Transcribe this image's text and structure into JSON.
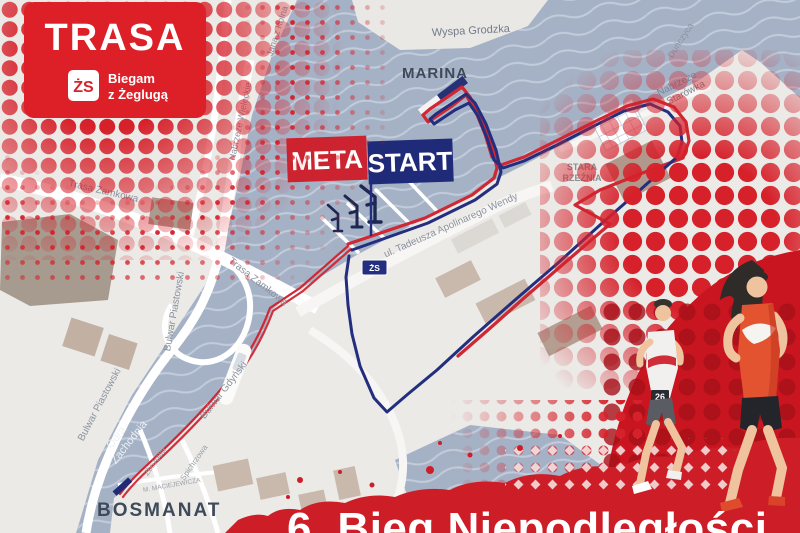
{
  "poster": {
    "title": "TRASA",
    "logo": {
      "initials": "ŻS",
      "line1": "Biegam",
      "line2": "z Żeglugą"
    },
    "event_title": "6. Bieg Niepodległości"
  },
  "route": {
    "finish_label": "META",
    "start_label": "START",
    "badge_label": "ŻS"
  },
  "map": {
    "labels": {
      "wyspa_grodzka": "Wyspa Grodzka",
      "marina": "MARINA",
      "dunczyca": "Duńczyca",
      "starowka_1": "Nabrzeże",
      "starowka_2": "Starówka",
      "stara_rzeznia_1": "STARA",
      "stara_rzeznia_2": "RZEŹNIA",
      "wendy": "ul. Tadeusza Apolinarego Wendy",
      "jana_z_kolna": "Jana z Kolna",
      "nabrzeze_wieleckie": "Nabrzeże Wieleckie",
      "trasa_zamkowa_a": "Trasa Zamkowa",
      "trasa_zamkowa_b": "Trasa Zamkowa",
      "bulwar_piastowski_a": "Bulwar Piastowski",
      "bulwar_piastowski_b": "Bulwar Piastowski",
      "bulwar_gdynski": "Bulwar Gdyński",
      "odra_1": "Odra",
      "odra_2": "Zachodnia",
      "zbozowa": "Zbożowa",
      "spichrzowa": "Spichrzowa",
      "maciejewicza": "M. MACIEJEWICZA",
      "bosmanat": "BOSMANAT"
    }
  },
  "runners": {
    "bib_number": "26"
  },
  "colors": {
    "accent_red": "#d6212b",
    "route_red": "#cf2733",
    "navy": "#232e7e",
    "water": "#a5b2c6",
    "land": "#ebeae7"
  }
}
